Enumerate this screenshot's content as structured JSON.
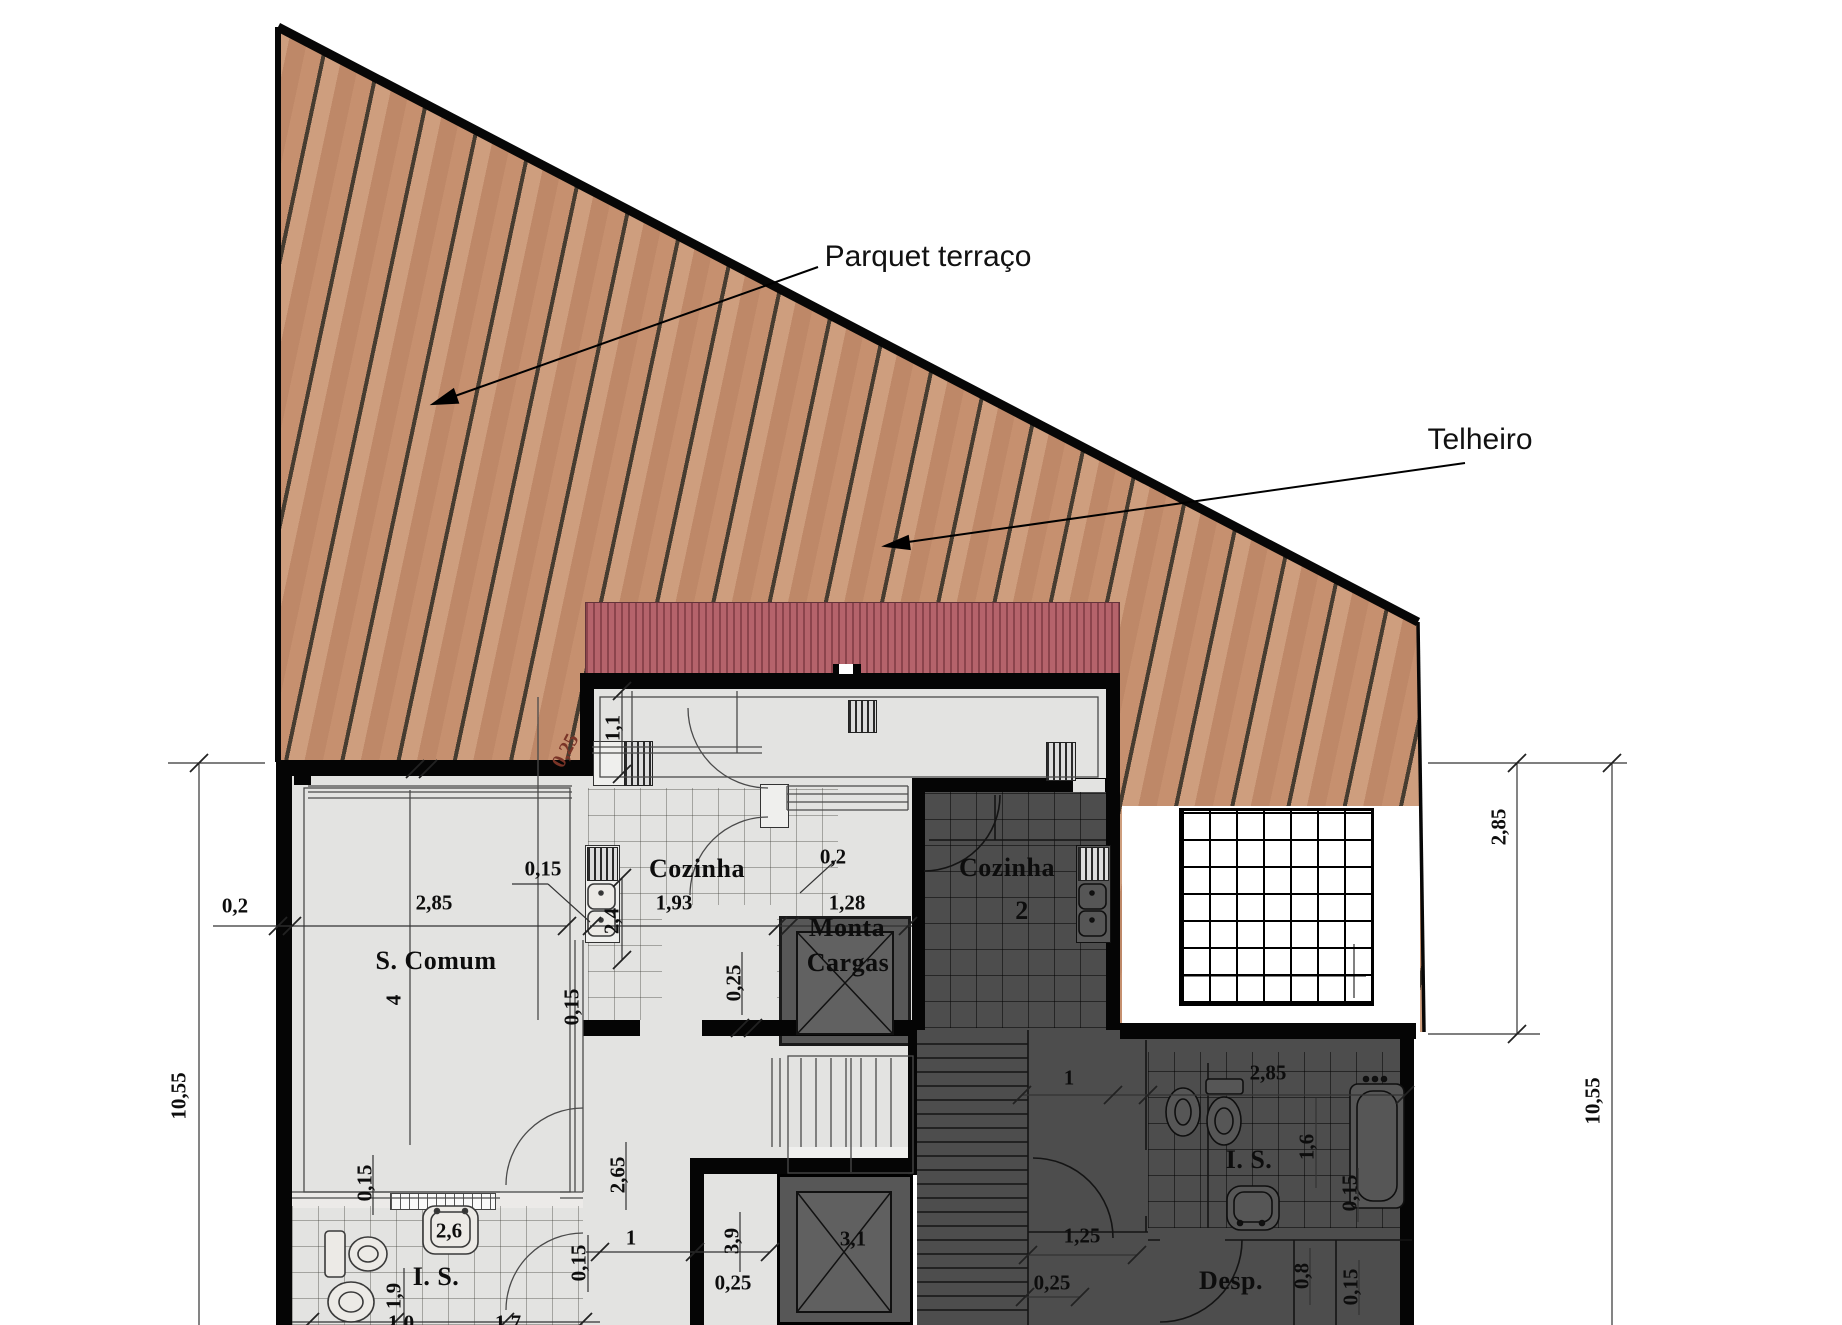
{
  "annotations": {
    "parquet": "Parquet terraço",
    "telheiro": "Telheiro"
  },
  "colors": {
    "deck": "#c6906f",
    "deck_line": "#463c30",
    "roof": "#b5636b",
    "interior": "#e3e3e1",
    "dark_room": "#4d4d4d",
    "wall": "#050505",
    "shaft": "#575757"
  },
  "plan": {
    "labels": [
      {
        "t": "S. Comum",
        "x": 436,
        "y": 961,
        "c": "room",
        "n": "label-room-s-comum"
      },
      {
        "t": "4",
        "x": 394,
        "y": 1000,
        "c": "dim v",
        "n": "label-room-4"
      },
      {
        "t": "Cozinha",
        "x": 697,
        "y": 869,
        "c": "room",
        "n": "label-room-cozinha-1"
      },
      {
        "t": "Cozinha",
        "x": 1007,
        "y": 868,
        "c": "room",
        "n": "label-room-cozinha-2"
      },
      {
        "t": "2",
        "x": 1022,
        "y": 911,
        "c": "room",
        "n": "label-room-cozinha-2-num"
      },
      {
        "t": "Monta",
        "x": 847,
        "y": 928,
        "c": "room",
        "n": "label-room-monta"
      },
      {
        "t": "Cargas",
        "x": 848,
        "y": 963,
        "c": "room",
        "n": "label-room-cargas"
      },
      {
        "t": "I. S.",
        "x": 436,
        "y": 1277,
        "c": "room",
        "n": "label-room-is-1"
      },
      {
        "t": "I. S.",
        "x": 1249,
        "y": 1160,
        "c": "room",
        "n": "label-room-is-2"
      },
      {
        "t": "Desp.",
        "x": 1231,
        "y": 1281,
        "c": "room",
        "n": "label-room-desp"
      },
      {
        "t": "0,2",
        "x": 235,
        "y": 906,
        "c": "dim",
        "n": "dim-0-2-left"
      },
      {
        "t": "2,85",
        "x": 434,
        "y": 903,
        "c": "dim",
        "n": "dim-2-85-scomum"
      },
      {
        "t": "0,15",
        "x": 543,
        "y": 869,
        "c": "dim",
        "n": "dim-0-15-wall"
      },
      {
        "t": "1,93",
        "x": 674,
        "y": 903,
        "c": "dim",
        "n": "dim-1-93-cozinha"
      },
      {
        "t": "0,2",
        "x": 833,
        "y": 857,
        "c": "dim",
        "n": "dim-0-2-monta"
      },
      {
        "t": "1,28",
        "x": 847,
        "y": 903,
        "c": "dim",
        "n": "dim-1-28-monta"
      },
      {
        "t": "1,1",
        "x": 613,
        "y": 728,
        "c": "dim v",
        "n": "dim-1-1"
      },
      {
        "t": "0,25",
        "x": 566,
        "y": 751,
        "c": "deckdim",
        "n": "dim-0-25-deck"
      },
      {
        "t": "2,4",
        "x": 612,
        "y": 921,
        "c": "dim v",
        "n": "dim-2-4"
      },
      {
        "t": "0,15",
        "x": 572,
        "y": 1007,
        "c": "dim v",
        "n": "dim-0-15-v1"
      },
      {
        "t": "0,25",
        "x": 734,
        "y": 983,
        "c": "dim v",
        "n": "dim-0-25-v"
      },
      {
        "t": "0,15",
        "x": 365,
        "y": 1183,
        "c": "dim v",
        "n": "dim-0-15-bath1"
      },
      {
        "t": "2,6",
        "x": 449,
        "y": 1231,
        "c": "dim",
        "n": "dim-2-6"
      },
      {
        "t": "1,9",
        "x": 394,
        "y": 1296,
        "c": "dim v",
        "n": "dim-1-9"
      },
      {
        "t": "2,65",
        "x": 618,
        "y": 1175,
        "c": "dim v",
        "n": "dim-2-65"
      },
      {
        "t": "1",
        "x": 631,
        "y": 1238,
        "c": "dim",
        "n": "dim-1-corridor"
      },
      {
        "t": "0,15",
        "x": 579,
        "y": 1263,
        "c": "dim v",
        "n": "dim-0-15-corr"
      },
      {
        "t": "3,9",
        "x": 732,
        "y": 1241,
        "c": "dim v",
        "n": "dim-3-9"
      },
      {
        "t": "0,25",
        "x": 733,
        "y": 1283,
        "c": "dim",
        "n": "dim-0-25-stair"
      },
      {
        "t": "3,1",
        "x": 853,
        "y": 1239,
        "c": "dim",
        "n": "dim-3-1-elevator"
      },
      {
        "t": "1",
        "x": 1069,
        "y": 1078,
        "c": "dim",
        "n": "dim-1-dark"
      },
      {
        "t": "2,85",
        "x": 1268,
        "y": 1073,
        "c": "dim",
        "n": "dim-2-85-is2"
      },
      {
        "t": "1,6",
        "x": 1307,
        "y": 1147,
        "c": "dim v",
        "n": "dim-1-6"
      },
      {
        "t": "0,15",
        "x": 1350,
        "y": 1193,
        "c": "dim v",
        "n": "dim-0-15-is2"
      },
      {
        "t": "1,25",
        "x": 1082,
        "y": 1236,
        "c": "dim",
        "n": "dim-1-25"
      },
      {
        "t": "0,25",
        "x": 1052,
        "y": 1283,
        "c": "dim",
        "n": "dim-0-25-dark"
      },
      {
        "t": "0,8",
        "x": 1302,
        "y": 1276,
        "c": "dim v",
        "n": "dim-0-8"
      },
      {
        "t": "0,15",
        "x": 1351,
        "y": 1287,
        "c": "dim v",
        "n": "dim-0-15-desp"
      },
      {
        "t": "10,55",
        "x": 179,
        "y": 1096,
        "c": "dim v",
        "n": "dim-10-55-left"
      },
      {
        "t": "2,85",
        "x": 1499,
        "y": 827,
        "c": "dim v",
        "n": "dim-2-85-right"
      },
      {
        "t": "10,55",
        "x": 1593,
        "y": 1101,
        "c": "dim v",
        "n": "dim-10-55-right"
      },
      {
        "t": "1,0",
        "x": 401,
        "y": 1323,
        "c": "dim",
        "n": "dim-1-0-cut"
      },
      {
        "t": "1,7",
        "x": 508,
        "y": 1323,
        "c": "dim",
        "n": "dim-1-7-cut"
      }
    ]
  }
}
